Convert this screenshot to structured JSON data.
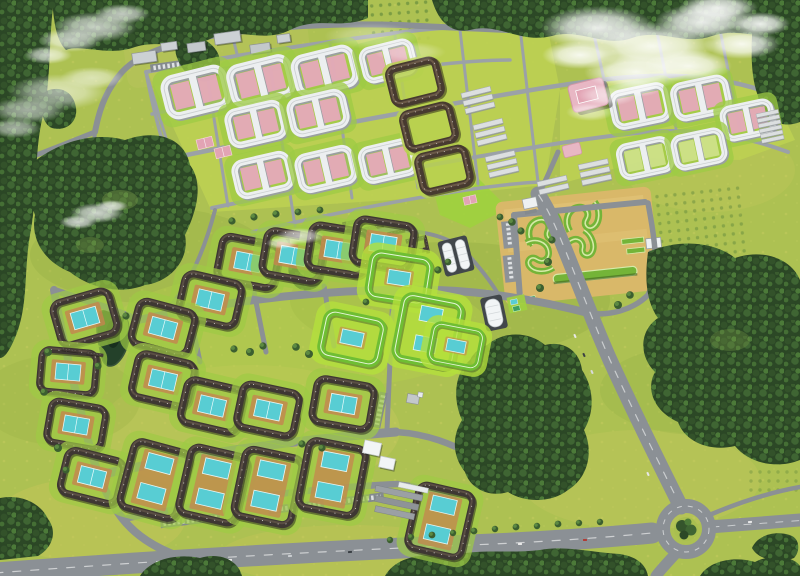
{
  "scene": {
    "alt": "Aerial bird's-eye rendering of a residential district master plan with apartment estates, forests, fields, roads and a roundabout",
    "kind": "architectural-aerial-visualization"
  },
  "colors": {
    "field_base": "#adc152",
    "lawn_bright": "#9ecb44",
    "estate_pad": "#bcd052",
    "speckle": "#d9d468",
    "forest_dark": "#2b4725",
    "road": "#8b9095",
    "road_minor": "#9ba1a7",
    "marking": "#dfe2e4",
    "roof_white": "#eceff0",
    "roof_dark": "#3e3733",
    "roof_green": "#6fbe33",
    "roof_brown": "#473a30",
    "court_teal": "#58cdd3",
    "court_pink": "#e5a9ba",
    "court_lime": "#cde089",
    "sand": "#d9b869",
    "school_pink": "#e8b7c4",
    "industrial_gray": "#ccd1d4",
    "pond": "#24412a",
    "cloud": "#ffffff",
    "arena_white": "#f2f5f6"
  },
  "features": [
    {
      "name": "upper-estate",
      "label": "Upper estate of white serpentine H-blocks with pink courtyards"
    },
    {
      "name": "dark-perimeter-blocks",
      "label": "Dark brown perimeter blocks with green courtyards"
    },
    {
      "name": "school-building",
      "label": "Pink-roofed school complex"
    },
    {
      "name": "industrial-zone",
      "label": "Gray flat-roof commercial buildings with parking"
    },
    {
      "name": "orange-estate",
      "label": "Sandy estate with green serpentine buildings"
    },
    {
      "name": "mid-estates",
      "label": "Mid-rise blocks with teal sport courts"
    },
    {
      "name": "green-roof-estates",
      "label": "Bright green roofed blocks with teal courts"
    },
    {
      "name": "south-estates",
      "label": "Lower apartment blocks with double teal courts"
    },
    {
      "name": "row-houses",
      "label": "Dark row houses"
    },
    {
      "name": "sports-arena",
      "label": "White barrel-roof sports halls"
    },
    {
      "name": "pond",
      "label": "Small dark pond"
    },
    {
      "name": "main-avenue",
      "label": "Main diagonal avenue"
    },
    {
      "name": "bottom-highway",
      "label": "Wide highway along the bottom"
    },
    {
      "name": "roundabout",
      "label": "Roundabout with tree island"
    },
    {
      "name": "forests",
      "label": "Dense forest patches"
    },
    {
      "name": "clouds",
      "label": "White clouds"
    },
    {
      "name": "orchards",
      "label": "Dotted orchard plantations"
    }
  ]
}
